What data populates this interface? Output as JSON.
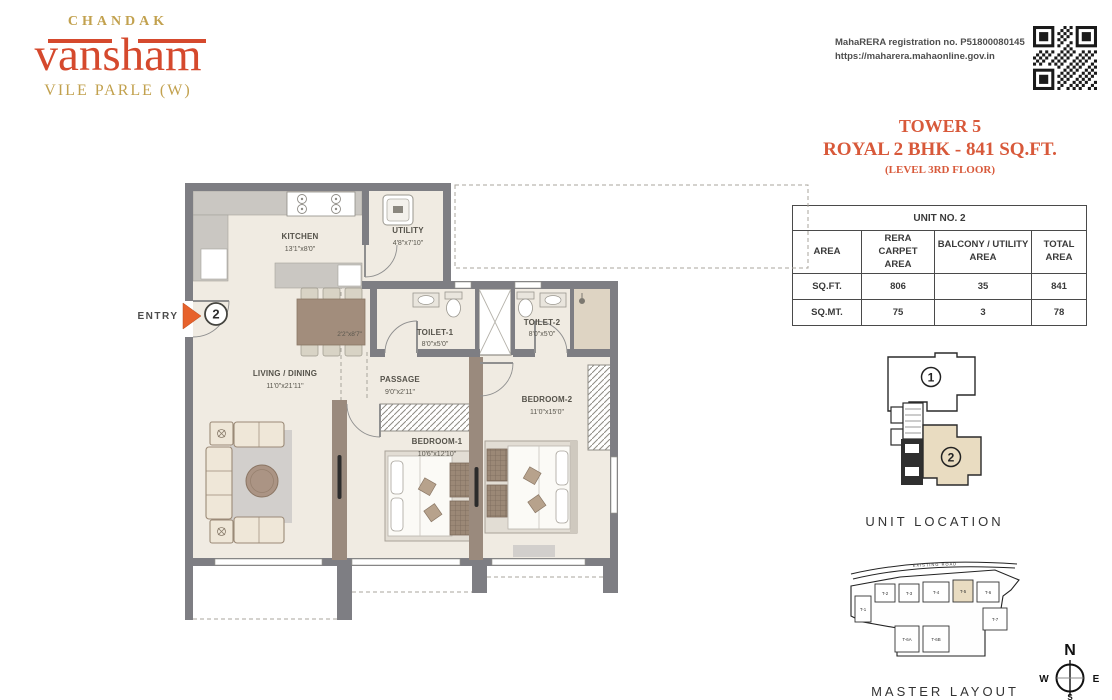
{
  "brand": {
    "name": "CHANDAK",
    "project": "vansham",
    "location": "VILE PARLE (W)"
  },
  "rera": {
    "line1": "MahaRERA registration no. P51800080145",
    "line2": "https://maharera.mahaonline.gov.in"
  },
  "title": {
    "tower": "TOWER 5",
    "unit": "ROYAL 2 BHK - 841 SQ.FT.",
    "level": "(LEVEL 3RD FLOOR)"
  },
  "area_table": {
    "title": "UNIT NO. 2",
    "columns": [
      "AREA",
      "RERA CARPET AREA",
      "BALCONY / UTILITY AREA",
      "TOTAL AREA"
    ],
    "rows": [
      {
        "label": "SQ.FT.",
        "carpet": "806",
        "balcony": "35",
        "total": "841"
      },
      {
        "label": "SQ.MT.",
        "carpet": "75",
        "balcony": "3",
        "total": "78"
      }
    ]
  },
  "plan": {
    "entry_label": "ENTRY",
    "entry_unit": "2",
    "rooms": {
      "kitchen": {
        "name": "KITCHEN",
        "dims": "13'1\"x8'0\""
      },
      "utility": {
        "name": "UTILITY",
        "dims": "4'8\"x7'10\""
      },
      "toilet1": {
        "name": "TOILET-1",
        "dims": "8'0\"x5'0\""
      },
      "toilet2": {
        "name": "TOILET-2",
        "dims": "8'0\"x5'0\""
      },
      "passage": {
        "name": "PASSAGE",
        "dims": "9'0\"x2'11\""
      },
      "living": {
        "name": "LIVING / DINING",
        "dims": "11'0\"x21'11\""
      },
      "bedroom1": {
        "name": "BEDROOM-1",
        "dims": "10'6\"x12'10\""
      },
      "bedroom2": {
        "name": "BEDROOM-2",
        "dims": "11'0\"x15'0\""
      },
      "dining_table": {
        "dims": "2'2\"x8'7\""
      }
    }
  },
  "unit_location": {
    "caption": "UNIT LOCATION",
    "unit1": "1",
    "unit2": "2"
  },
  "master_layout": {
    "caption": "MASTER LAYOUT",
    "road": "EXISTING ROAD",
    "towers": [
      "T-1",
      "T-2",
      "T-3",
      "T-4",
      "T-5",
      "T-6",
      "T-7",
      "T-6A",
      "T-6B"
    ]
  },
  "compass": {
    "n": "N",
    "e": "E",
    "w": "W",
    "s": "S"
  }
}
